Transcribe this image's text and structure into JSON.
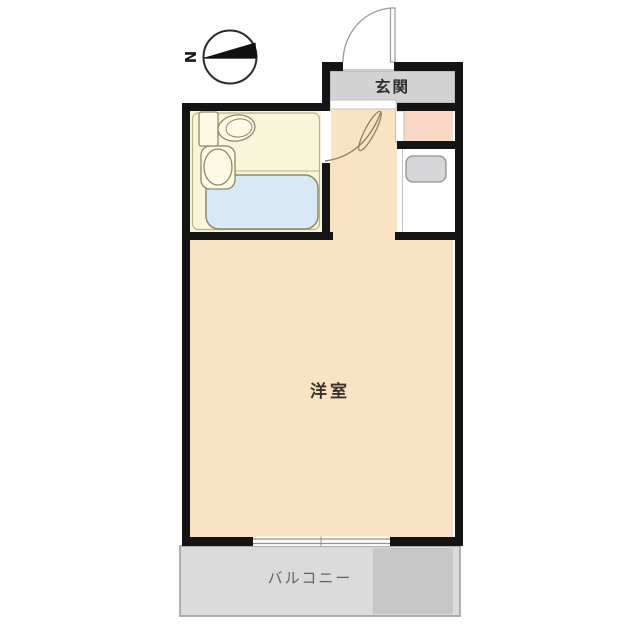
{
  "compass": {
    "north_label": "N",
    "needle_icon": "black-triangle-pointing-west"
  },
  "rooms": {
    "entrance": {
      "label": "玄関"
    },
    "western_room": {
      "label": "洋室"
    },
    "balcony": {
      "label": "バルコニー"
    }
  },
  "fixtures": {
    "toilet": "toilet-icon",
    "sink": "sink-icon",
    "bathtub": "bathtub-icon",
    "washing_machine": "washing-machine-icon"
  },
  "colors": {
    "wall": "#141414",
    "room_fill": "#fae3c5",
    "bathroom_fill": "#f8f5d9",
    "bathtub_fill": "#d8e9f5",
    "entrance_fill": "#d3d3d3",
    "nook_fill": "#f9d9c5",
    "washer_fill": "#d6d6d8",
    "balcony_fill": "#dbdbdb",
    "balcony_dark_fill": "#c7c7c7",
    "door_line": "#96805f",
    "fixture_outline": "#8a8a6a",
    "window_line": "#8f8f8f"
  }
}
